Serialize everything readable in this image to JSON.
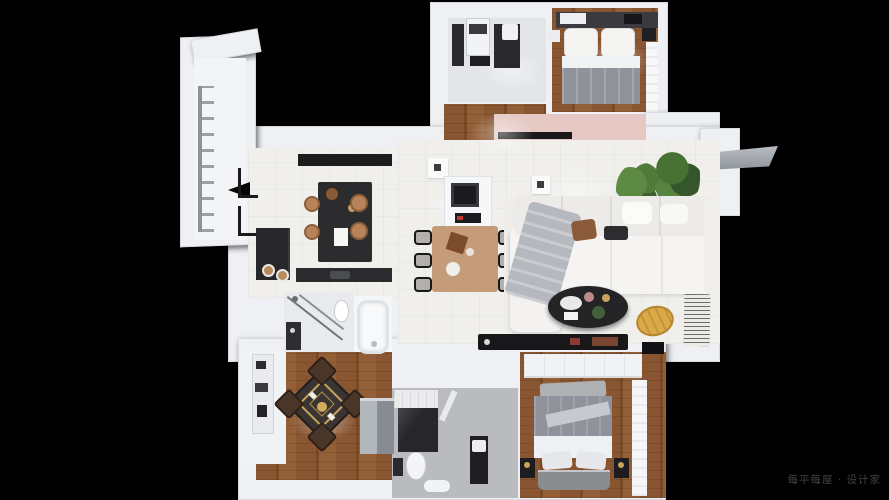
{
  "meta": {
    "scene": "3d-apartment-floor-plan-top-down-render",
    "canvas": {
      "width": 889,
      "height": 500
    }
  },
  "watermark": {
    "text": "每平每屋 · 设计家"
  },
  "colors": {
    "background": "#000000",
    "wall": "#eef0f3",
    "wood": "#8a5632",
    "tile": "#f0efec",
    "counter_dark": "#29292c",
    "island_dark": "#2c2c2f",
    "table_wood": "#c49c7a",
    "stool": "#b9835a",
    "sofa_white": "#f5f4f2",
    "blanket_gray": "#b5b8be",
    "coffee_table": "#242427",
    "beanbag_gold": "#dca947",
    "mahjong_dark": "#3a3533",
    "mahjong_gold": "#c9a45c",
    "chair_brown": "#4a3628",
    "bed_gray": "#8f929a",
    "plant_green": "#4f7a38",
    "closet_pink": "#e5c8c3",
    "glass_gray": "#70767c",
    "wardrobe_gray": "#9aa0a5",
    "bathroom_floor_gray": "#b9bbbe",
    "watermark_color": "#4f4f4f"
  },
  "rooms": [
    {
      "id": "balcony-left",
      "features": [
        "drying-rack"
      ]
    },
    {
      "id": "bathroom-top",
      "features": [
        "washer",
        "dark-counter",
        "sink"
      ]
    },
    {
      "id": "bedroom-second",
      "features": [
        "double-bed",
        "pillows",
        "nightstand",
        "curtain"
      ]
    },
    {
      "id": "hallway",
      "features": [
        "wood-floor"
      ]
    },
    {
      "id": "entry-closet",
      "features": [
        "pink-shelf",
        "shoe-cabinet"
      ]
    },
    {
      "id": "kitchen",
      "features": [
        "island",
        "stools",
        "hood",
        "cabinet",
        "plates"
      ]
    },
    {
      "id": "living-dining",
      "features": [
        "dining-table",
        "six-chairs",
        "sideboard",
        "sofa",
        "coffee-table",
        "beanbag",
        "book-stack",
        "tv-console"
      ]
    },
    {
      "id": "plant-corner",
      "features": [
        "potted-plants"
      ]
    },
    {
      "id": "bathroom-middle",
      "features": [
        "shower-glass",
        "toilet",
        "sink"
      ]
    },
    {
      "id": "bathtub-room",
      "features": [
        "bathtub"
      ]
    },
    {
      "id": "mahjong-room",
      "features": [
        "square-game-table",
        "four-chairs",
        "gray-wardrobe"
      ]
    },
    {
      "id": "utility-balcony",
      "features": [
        "shelf"
      ]
    },
    {
      "id": "bathroom-bottom",
      "features": [
        "shower",
        "toilet",
        "vanity",
        "bathmat"
      ]
    },
    {
      "id": "bedroom-master",
      "features": [
        "double-bed",
        "wardrobe",
        "nightstands",
        "curtain"
      ]
    }
  ]
}
